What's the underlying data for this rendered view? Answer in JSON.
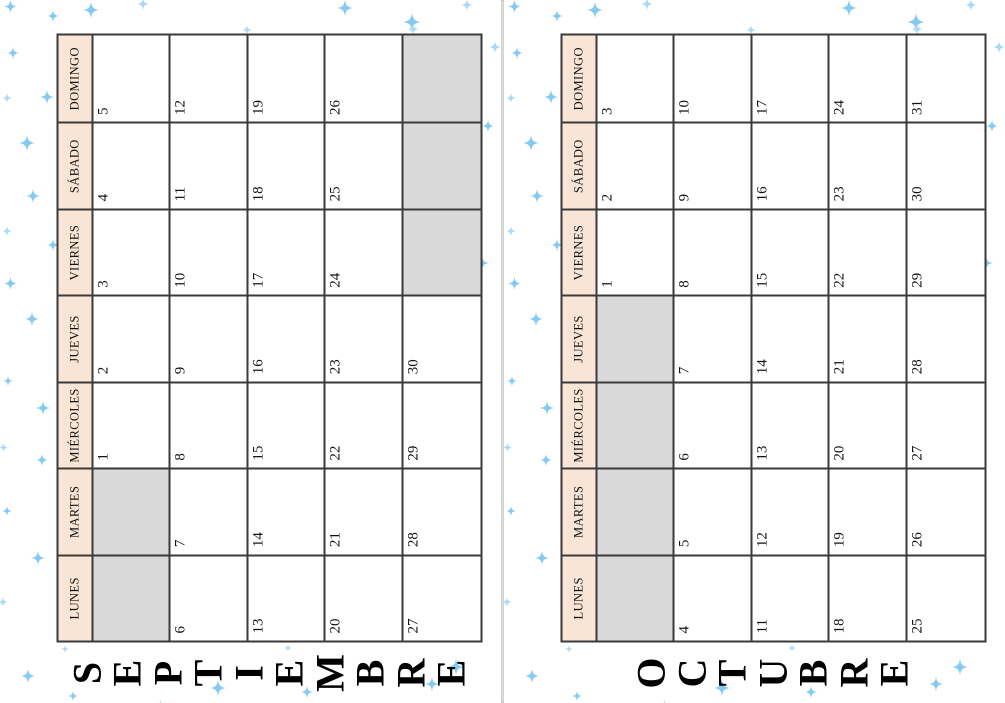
{
  "document": {
    "type": "printable-calendar-spread",
    "language": "es",
    "page_count_visible": 2
  },
  "colors": {
    "page_bg": "#ffffff",
    "header_bg": "#f9e5d5",
    "blank_bg": "#d9d9d9",
    "grid_border": "#3a3a3a",
    "divider": "#d6d6d6",
    "title_color": "#000000",
    "sparkle_main": "#85caf3",
    "sparkle_light": "#abd9f7"
  },
  "day_headers": [
    "LUNES",
    "MARTES",
    "MIÉRCOLES",
    "JUEVES",
    "VIERNES",
    "SÁBADO",
    "DOMINGO"
  ],
  "months": [
    {
      "name": "SEPTIEMBRE",
      "letters": [
        "S",
        "E",
        "P",
        "T",
        "I",
        "E",
        "M",
        "B",
        "R",
        "E"
      ],
      "weeks": [
        [
          null,
          null,
          "1",
          "2",
          "3",
          "4",
          "5"
        ],
        [
          "6",
          "7",
          "8",
          "9",
          "10",
          "11",
          "12"
        ],
        [
          "13",
          "14",
          "15",
          "16",
          "17",
          "18",
          "19"
        ],
        [
          "20",
          "21",
          "22",
          "23",
          "24",
          "25",
          "26"
        ],
        [
          "27",
          "28",
          "29",
          "30",
          null,
          null,
          null
        ]
      ]
    },
    {
      "name": "OCTUBRE",
      "letters": [
        "O",
        "C",
        "T",
        "U",
        "B",
        "R",
        "E"
      ],
      "weeks": [
        [
          null,
          null,
          null,
          null,
          "1",
          "2",
          "3"
        ],
        [
          "4",
          "5",
          "6",
          "7",
          "8",
          "9",
          "10"
        ],
        [
          "11",
          "12",
          "13",
          "14",
          "15",
          "16",
          "17"
        ],
        [
          "18",
          "19",
          "20",
          "21",
          "22",
          "23",
          "24"
        ],
        [
          "25",
          "26",
          "27",
          "28",
          "29",
          "30",
          "31"
        ]
      ]
    }
  ],
  "sparkles": [
    {
      "x": 91,
      "y": 10,
      "s": 16,
      "tone": 0
    },
    {
      "x": 345,
      "y": 8,
      "s": 16,
      "tone": 0
    },
    {
      "x": 412,
      "y": 22,
      "s": 18,
      "tone": 0
    },
    {
      "x": 143,
      "y": 3,
      "s": 12,
      "tone": 1
    },
    {
      "x": 53,
      "y": 15,
      "s": 12,
      "tone": 0
    },
    {
      "x": 10,
      "y": 6,
      "s": 13,
      "tone": 0
    },
    {
      "x": 467,
      "y": 4,
      "s": 12,
      "tone": 1
    },
    {
      "x": 13,
      "y": 52,
      "s": 12,
      "tone": 0
    },
    {
      "x": 7,
      "y": 95,
      "s": 10,
      "tone": 1
    },
    {
      "x": 47,
      "y": 97,
      "s": 14,
      "tone": 0
    },
    {
      "x": 27,
      "y": 143,
      "s": 16,
      "tone": 0
    },
    {
      "x": 33,
      "y": 196,
      "s": 14,
      "tone": 0
    },
    {
      "x": 7,
      "y": 228,
      "s": 10,
      "tone": 1
    },
    {
      "x": 53,
      "y": 244,
      "s": 12,
      "tone": 0
    },
    {
      "x": 10,
      "y": 283,
      "s": 13,
      "tone": 0
    },
    {
      "x": 32,
      "y": 319,
      "s": 14,
      "tone": 0
    },
    {
      "x": 8,
      "y": 378,
      "s": 10,
      "tone": 0
    },
    {
      "x": 43,
      "y": 408,
      "s": 14,
      "tone": 0
    },
    {
      "x": 3,
      "y": 443,
      "s": 9,
      "tone": 1
    },
    {
      "x": 42,
      "y": 459,
      "s": 12,
      "tone": 0
    },
    {
      "x": 7,
      "y": 508,
      "s": 10,
      "tone": 0
    },
    {
      "x": 38,
      "y": 558,
      "s": 14,
      "tone": 0
    },
    {
      "x": 3,
      "y": 599,
      "s": 10,
      "tone": 1
    },
    {
      "x": 28,
      "y": 676,
      "s": 14,
      "tone": 0
    },
    {
      "x": 495,
      "y": 46,
      "s": 12,
      "tone": 1
    },
    {
      "x": 488,
      "y": 125,
      "s": 12,
      "tone": 0
    },
    {
      "x": 482,
      "y": 263,
      "s": 14,
      "tone": 0
    },
    {
      "x": 247,
      "y": 27,
      "s": 10,
      "tone": 1
    },
    {
      "x": 413,
      "y": 28,
      "s": 12,
      "tone": 1
    },
    {
      "x": 65,
      "y": 644,
      "s": 8,
      "tone": 1
    },
    {
      "x": 73,
      "y": 693,
      "s": 10,
      "tone": 0
    },
    {
      "x": 218,
      "y": 688,
      "s": 16,
      "tone": 0
    },
    {
      "x": 307,
      "y": 691,
      "s": 12,
      "tone": 0
    },
    {
      "x": 432,
      "y": 684,
      "s": 14,
      "tone": 0
    },
    {
      "x": 288,
      "y": 643,
      "s": 8,
      "tone": 1
    },
    {
      "x": 160,
      "y": 700,
      "s": 9,
      "tone": 1
    },
    {
      "x": 456,
      "y": 667,
      "s": 16,
      "tone": 0
    }
  ]
}
